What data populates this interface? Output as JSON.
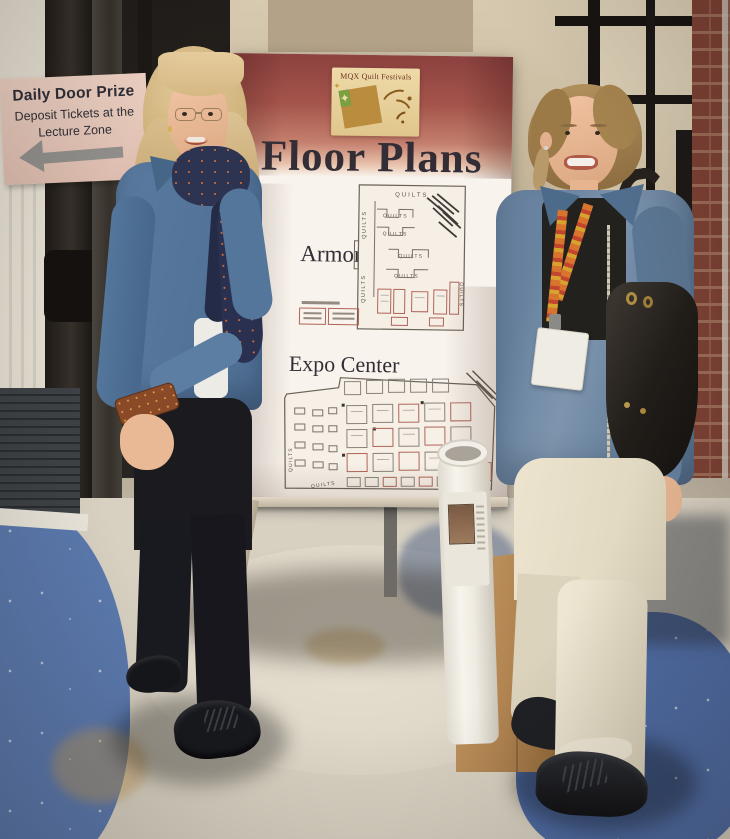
{
  "scene": {
    "label": "Two attendees beside the MQX Quilt Festivals floor-plan easel sign",
    "quilt_glyph": "✦"
  },
  "door_prize_sign": {
    "title": "Daily Door Prize",
    "line1": "Deposit Tickets at the",
    "line2": "Lecture Zone",
    "arrow_icon": "left-arrow",
    "bg_color": "#e7cbbc",
    "arrow_color": "#908e8b"
  },
  "poster": {
    "brand": "MQX Quilt Festivals",
    "title": "Floor Plans",
    "sections": [
      {
        "label": "Armory"
      },
      {
        "label": "Expo Center"
      }
    ],
    "quilts_label": "QUILTS",
    "colors": {
      "header_maroon": "#97453e",
      "logo_cream": "#e9d3a0",
      "logo_orange": "#d4682e",
      "logo_blue": "#3c6cae",
      "logo_green": "#7aa23c",
      "plan_line": "#6a6258",
      "booth_red": "#b06458"
    }
  },
  "colors": {
    "denim_jacket": "#5d7ea3",
    "carpet_blue": "#52709f",
    "carpet_cream": "#d8d1c2",
    "brick": "#7c4034",
    "paper_bag": "#b08350",
    "black_pants": "#18181d",
    "khaki_pants": "#e8e0ca",
    "scarf_navy": "#2c3452",
    "lanyard_orange": "#d8742e"
  }
}
